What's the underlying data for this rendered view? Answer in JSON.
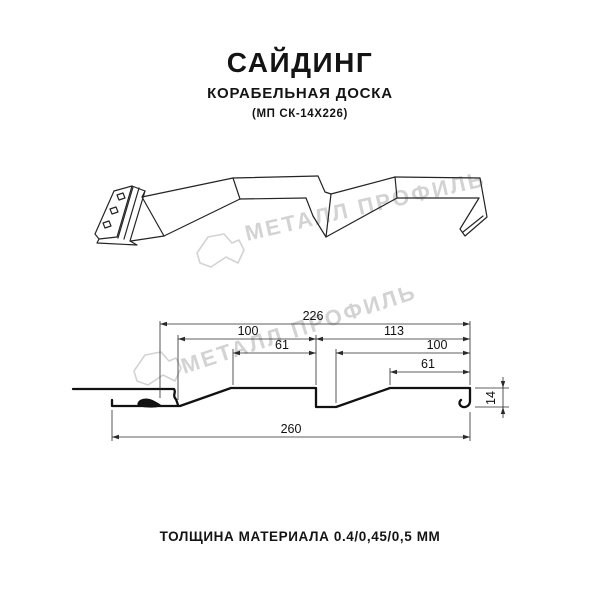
{
  "header": {
    "title": "САЙДИНГ",
    "subtitle": "КОРАБЕЛЬНАЯ ДОСКА",
    "model_code": "(МП СК-14Х226)"
  },
  "watermark": {
    "brand_text": "МЕТАЛЛ ПРОФИЛЬ",
    "color": "#d3d3d3",
    "logo": "metall-profil-crystal-logo"
  },
  "drawing": {
    "type": "technical profile section",
    "line_color": "#1a1a1a",
    "dimensions": {
      "overall_module": "226",
      "left_span": "100",
      "right_span": "113",
      "left_flat": "61",
      "right_face": "100",
      "right_flat": "61",
      "profile_height": "14",
      "overall_width": "260"
    }
  },
  "footer": {
    "thickness_note": "ТОЛЩИНА МАТЕРИАЛА 0.4/0,45/0,5 ММ"
  }
}
